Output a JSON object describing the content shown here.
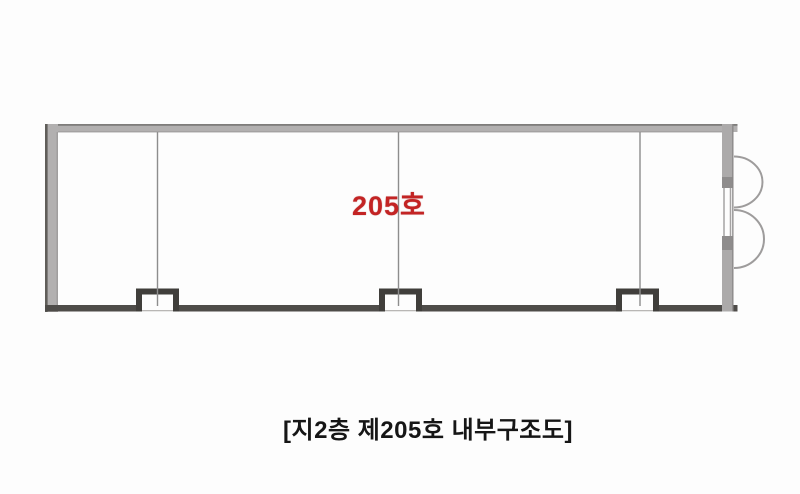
{
  "floor_plan": {
    "room_label": "205호",
    "caption": "[지2층 제205호 내부구조도]",
    "colors": {
      "background": "#fdfdfd",
      "wall_gray": "#b2b0b0",
      "wall_edge_dark": "#66645f",
      "right_wall_gray": "#acaaaa",
      "door_jamb_gray": "#8e8c8c",
      "bottom_wall_dark": "#4e4c49",
      "partition_line": "#8d8d8d",
      "column_notch_dark": "#403e3b",
      "door_arc": "#9e9c9c",
      "room_label_red": "#c32424",
      "caption_black": "#161616"
    },
    "elements": {
      "partition_count": 3,
      "column_notch_count": 3,
      "door_arc_count": 2
    }
  }
}
